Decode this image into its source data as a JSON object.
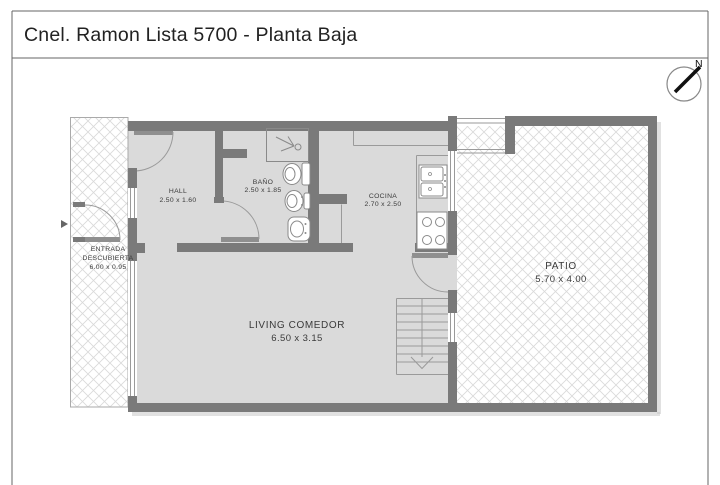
{
  "header": {
    "title": "Cnel. Ramon Lista 5700 - Planta Baja"
  },
  "compass": {
    "north_label": "N"
  },
  "rooms": {
    "hall": {
      "label": "HALL",
      "dimensions": "2.50 x 1.60"
    },
    "banio": {
      "label": "BAÑO",
      "dimensions": "2.50 x 1.85"
    },
    "cocina": {
      "label": "COCINA",
      "dimensions": "2.70 x 2.50"
    },
    "entrada_descubierta": {
      "label_line1": "ENTRADA",
      "label_line2": "DESCUBIERTA",
      "dimensions": "6.00 x 0.95"
    },
    "living_comedor": {
      "label": "LIVING COMEDOR",
      "dimensions": "6.50 x 3.15"
    },
    "patio": {
      "label": "PATIO",
      "dimensions": "5.70 x 4.00"
    }
  },
  "colors": {
    "wall": "#7a7a7a",
    "floor": "#dadada",
    "outline": "#9a9a9a",
    "hatch_line": "#d9d9d9",
    "label_text": "#3a3a3a"
  }
}
